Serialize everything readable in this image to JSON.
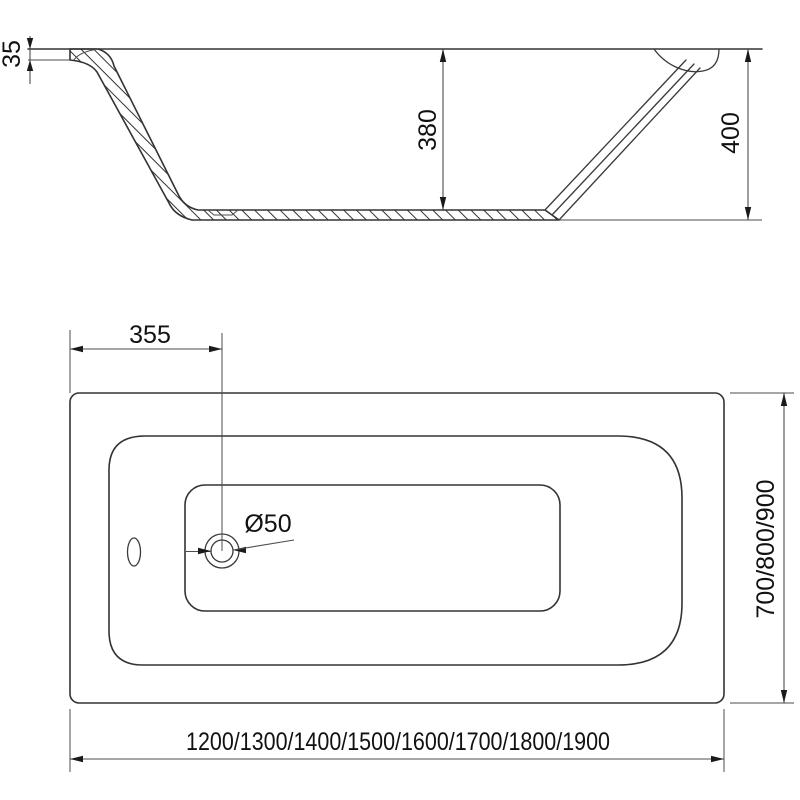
{
  "colors": {
    "background": "#ffffff",
    "outline": "#333333",
    "dimension_lines": "#4d4d4d",
    "text": "#111111"
  },
  "side_view": {
    "dim_rim_thickness": "35",
    "dim_inner_depth": "380",
    "dim_overall_height": "400"
  },
  "plan_view": {
    "dim_drain_offset": "355",
    "dim_drain_diameter": "Ø50",
    "dim_width_options": "700/800/900",
    "dim_length_options": "1200/1300/1400/1500/1600/1700/1800/1900"
  }
}
